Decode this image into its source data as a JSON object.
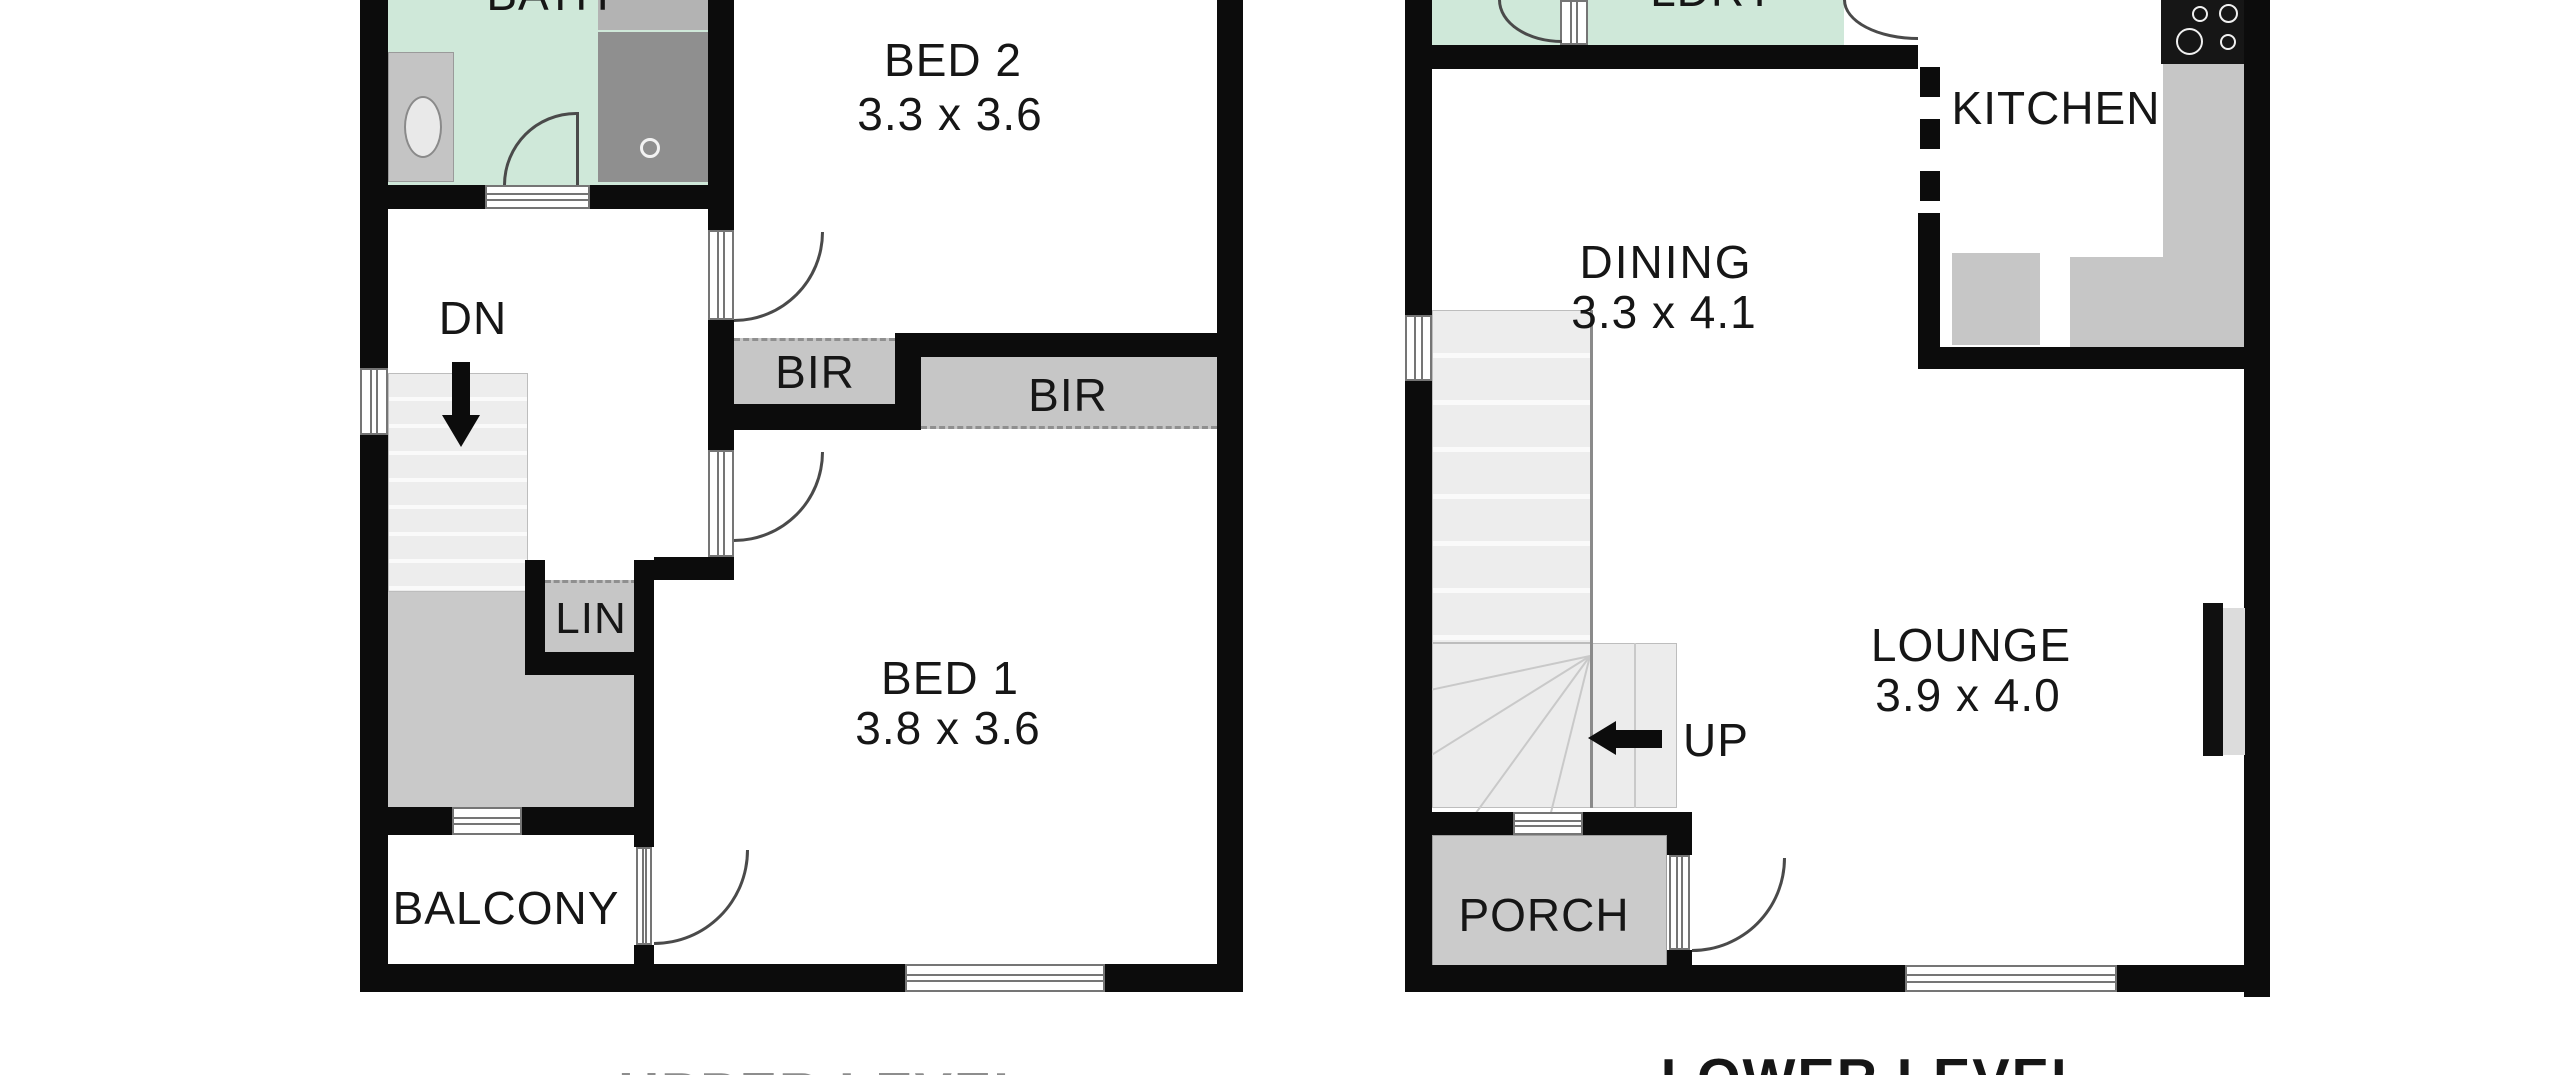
{
  "upper": {
    "title": "UPPER LEVEL",
    "bath": "BATH",
    "bed2": "BED 2",
    "bed2_dims": "3.3 x 3.6",
    "bed1": "BED 1",
    "bed1_dims": "3.8 x 3.6",
    "bir1": "BIR",
    "bir2": "BIR",
    "lin": "LIN",
    "balcony": "BALCONY",
    "dn": "DN"
  },
  "lower": {
    "title": "LOWER LEVEL",
    "ldry": "LDRY",
    "kitchen": "KITCHEN",
    "dining": "DINING",
    "dining_dims": "3.3 x 4.1",
    "lounge": "LOUNGE",
    "lounge_dims": "3.9 x 4.0",
    "porch": "PORCH",
    "up": "UP"
  },
  "colors": {
    "wall": "#0c0c0c",
    "wet_floor": "#cfe8d9",
    "closet": "#c6c6c6",
    "shower": "#8f8f8f",
    "stairs": "#ededed",
    "landing": "#c9c9c9",
    "porch": "#cbcbcb",
    "text": "#161616"
  }
}
